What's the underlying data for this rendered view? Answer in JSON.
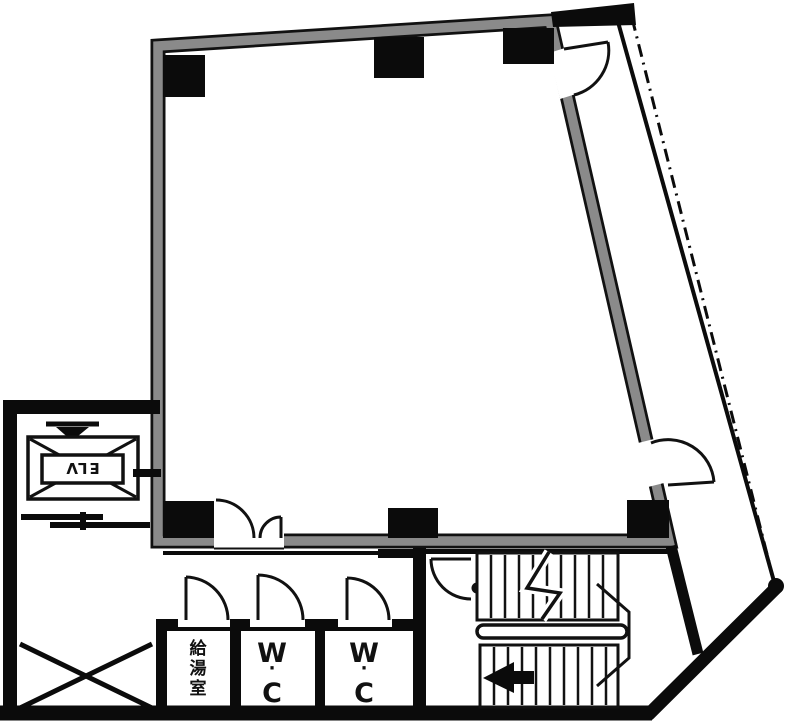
{
  "document": {
    "type": "architectural-floor-plan",
    "colors": {
      "wall_gray": "#8a8a8a",
      "ink": "#111111",
      "background": "#ffffff"
    },
    "rooms": {
      "elevator": {
        "label": "ELV",
        "label_rotation_deg": 180
      },
      "kitchenette": {
        "label": "給湯室",
        "label_chars": [
          "給",
          "湯",
          "室"
        ],
        "orientation": "vertical"
      },
      "toilet_1": {
        "label": "W·C",
        "chars": {
          "w": "W",
          "dot": "·",
          "c": "C"
        }
      },
      "toilet_2": {
        "label": "W·C",
        "chars": {
          "w": "W",
          "dot": "·",
          "c": "C"
        }
      },
      "main_room": {
        "label": ""
      },
      "stairwell": {
        "label": ""
      }
    },
    "symbols": {
      "columns_count": 6,
      "door_arcs_count": 8,
      "stair_flights": 2,
      "elevator_shaft_cross": true,
      "void_cross_bottom_left": true,
      "stair_direction_arrow": "left"
    }
  }
}
